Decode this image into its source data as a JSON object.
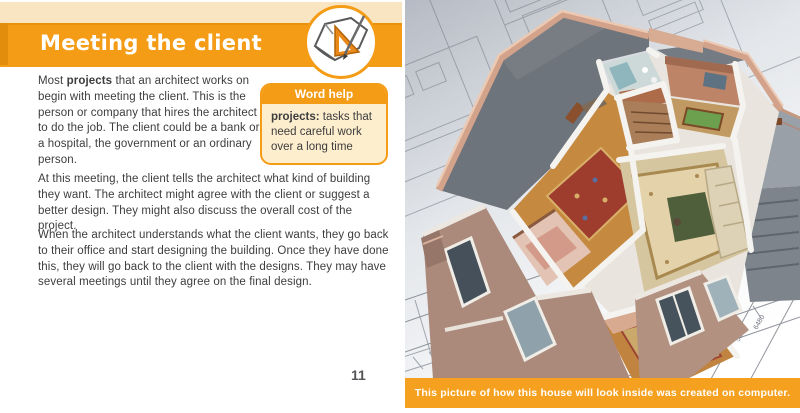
{
  "colors": {
    "accent_orange": "#f49c15",
    "cream": "#fae5c2",
    "wordhelp_bg": "#fdeecd",
    "body_text": "#3d3d3f",
    "roof_gray": "#6e747b",
    "parapet_pink": "#d3a28b",
    "wall_mauve": "#ab8a7c"
  },
  "left_page": {
    "title": "Meeting the client",
    "paragraph1": {
      "pre": "Most ",
      "bold": "projects",
      "post": " that an architect works on begin with meeting the client.  This is the person or company that hires the architect to do the job.  The client could be a bank or a hospital, the government or an ordinary person."
    },
    "paragraph2": "At this meeting, the client tells the architect what kind of building they want.  The architect might agree with the client or suggest a better design.  They might also discuss the overall cost of the project.",
    "paragraph3": "When the architect understands what the client wants, they go back to their office and start designing the building.  Once they have done this, they will go back to the client with the designs.  They may have several meetings until they agree on the final design.",
    "word_help": {
      "title": "Word help",
      "term": "projects:",
      "definition": " tasks that need careful work over a long time"
    },
    "page_number": "11"
  },
  "right_page": {
    "caption": "This picture of how this house will look inside was created on computer.",
    "illustration": {
      "dimension_labels": [
        "16200",
        "12490",
        "6400",
        "1520",
        "2300",
        "1650",
        "2100",
        "5300",
        "6480"
      ]
    }
  }
}
